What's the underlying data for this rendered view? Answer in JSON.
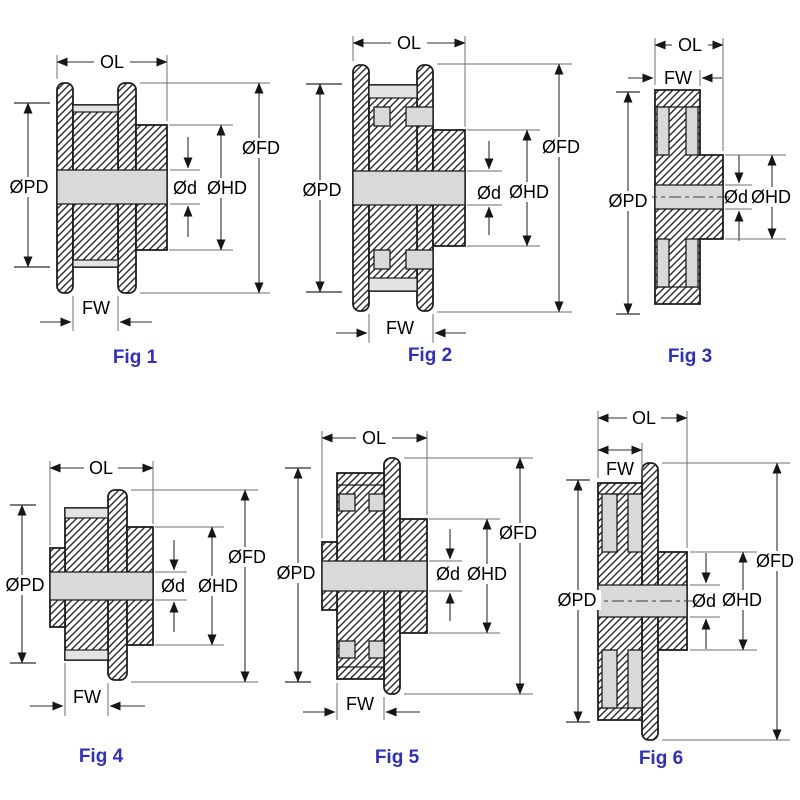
{
  "document": {
    "type": "timing-pulley-dimension-diagrams",
    "background": "#ffffff"
  },
  "colors": {
    "outline": "#1f1f1f",
    "dimension_line": "#2e2e2e",
    "extension_line": "#6f6f6f",
    "bore_fill": "#d9d9d9",
    "land_fill": "#e3e3e3",
    "caption_blue": "#2f2fc1",
    "label_text": "#000000"
  },
  "figures": [
    {
      "caption": "Fig 1",
      "labels": {
        "ol": "OL",
        "fw": "FW",
        "pd": "ØPD",
        "fd": "ØFD",
        "hd": "ØHD",
        "d": "Ød"
      }
    },
    {
      "caption": "Fig 2",
      "labels": {
        "ol": "OL",
        "fw": "FW",
        "pd": "ØPD",
        "fd": "ØFD",
        "hd": "ØHD",
        "d": "Ød"
      }
    },
    {
      "caption": "Fig 3",
      "labels": {
        "ol": "OL",
        "fw": "FW",
        "pd": "ØPD",
        "hd": "ØHD",
        "d": "Ød"
      }
    },
    {
      "caption": "Fig 4",
      "labels": {
        "ol": "OL",
        "fw": "FW",
        "pd": "ØPD",
        "fd": "ØFD",
        "hd": "ØHD",
        "d": "Ød"
      }
    },
    {
      "caption": "Fig 5",
      "labels": {
        "ol": "OL",
        "fw": "FW",
        "pd": "ØPD",
        "fd": "ØFD",
        "hd": "ØHD",
        "d": "Ød"
      }
    },
    {
      "caption": "Fig 6",
      "labels": {
        "ol": "OL",
        "fw": "FW",
        "pd": "ØPD",
        "fd": "ØFD",
        "hd": "ØHD",
        "d": "Ød"
      }
    }
  ]
}
